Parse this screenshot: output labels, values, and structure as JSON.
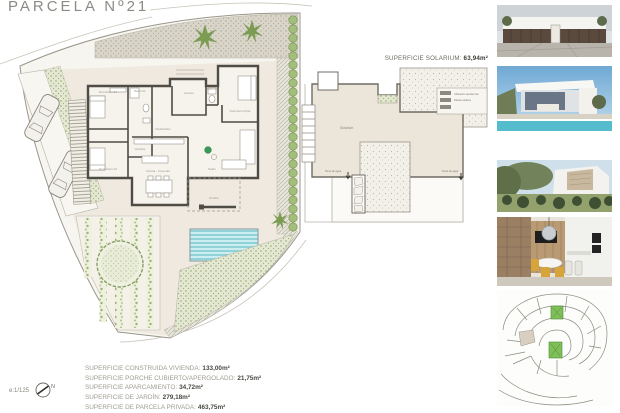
{
  "title": "PARCELA Nº21",
  "scale_label": "e:1/125",
  "compass": {
    "north": "N"
  },
  "colors": {
    "wall": "#4f4c45",
    "floor_beige": "#efe9df",
    "gravel_gray": "#d9d5c9",
    "plant_green": "#7d9c53",
    "hedge_green": "#a3bd7d",
    "pool_teal": "#cdeef0",
    "text_gray": "#8b8b85"
  },
  "floor_plan": {
    "rooms": {
      "dormitorio1": "Dormitorio 01",
      "bano1": "Baño 01",
      "vestidor": "Vestidor",
      "dormitorio2": "Dormitorio 02",
      "distribuidor": "Distribuidor",
      "acceso": "Acceso",
      "bano2": "Baño 02",
      "principal": "Dormitorio Ppal",
      "cocina": "Cocina - Comedor",
      "salon": "Salón",
      "porche": "Porche"
    }
  },
  "solarium_plan": {
    "title_label": "SUPERFICIE SOLARIUM:",
    "title_value": "63,94m²",
    "room_label": "Solarium",
    "legend_line1": "Ubicación aerotermia",
    "legend_line2": "Placas solares",
    "water_tap_left": "Toma de agua",
    "water_tap_right": "Toma de agua"
  },
  "areas": {
    "lines": [
      {
        "label": "SUPERFICIE CONSTRUIDA VIVIENDA:",
        "value": "133,00m²"
      },
      {
        "label": "SUPERFICIE PORCHE CUBIERTO/APERGOLADO:",
        "value": "21,75m²"
      },
      {
        "label": "SUPERFICIE APARCAMIENTO:",
        "value": "34,72m²"
      },
      {
        "label": "SUPERFICIE DE JARDÍN:",
        "value": "279,18m²"
      },
      {
        "label": "SUPERFICIE DE PARCELA PRIVADA:",
        "value": "463,75m²"
      }
    ]
  },
  "sidebar": {
    "photos": [
      "render-front-elevation",
      "render-pool-view",
      "render-garden-view",
      "render-interior-kitchen",
      "site-plan-map"
    ]
  }
}
